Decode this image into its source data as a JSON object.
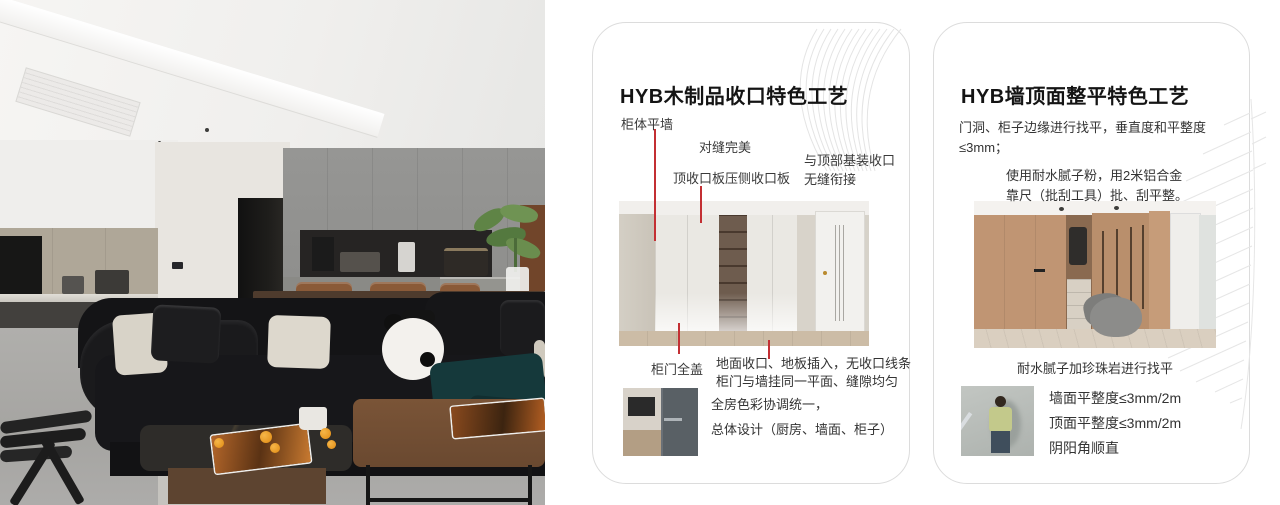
{
  "colors": {
    "accent_red": "#c32f33",
    "card_border": "#dcdcdc"
  },
  "cards": [
    {
      "title": "HYB木制品收口特色工艺",
      "callouts": {
        "cabinet_flush_wall": "柜体平墙",
        "perfect_seam": "对缝完美",
        "top_closing_board": "顶收口板压侧收口板",
        "top_joint_line1": "与顶部基装收口",
        "top_joint_line2": "无缝衔接",
        "full_cover_door": "柜门全盖"
      },
      "notes": {
        "floor_line1": "地面收口、地板插入，无收口线条",
        "floor_line2": "柜门与墙挂同一平面、缝隙均匀",
        "color_line1": "全房色彩协调统一，",
        "color_line2": "总体设计（厨房、墙面、柜子）"
      }
    },
    {
      "title": "HYB墙顶面整平特色工艺",
      "paragraphs": {
        "leveling": "门洞、柜子边缘进行找平，垂直度和平整度≤3mm；",
        "putty_line1": "使用耐水腻子粉，用2米铝合金",
        "putty_line2": "靠尺（批刮工具）批、刮平整。"
      },
      "caption": "耐水腻子加珍珠岩进行找平",
      "bullets": [
        "墙面平整度≤3mm/2m",
        "顶面平整度≤3mm/2m",
        "阴阳角顺直"
      ]
    }
  ]
}
